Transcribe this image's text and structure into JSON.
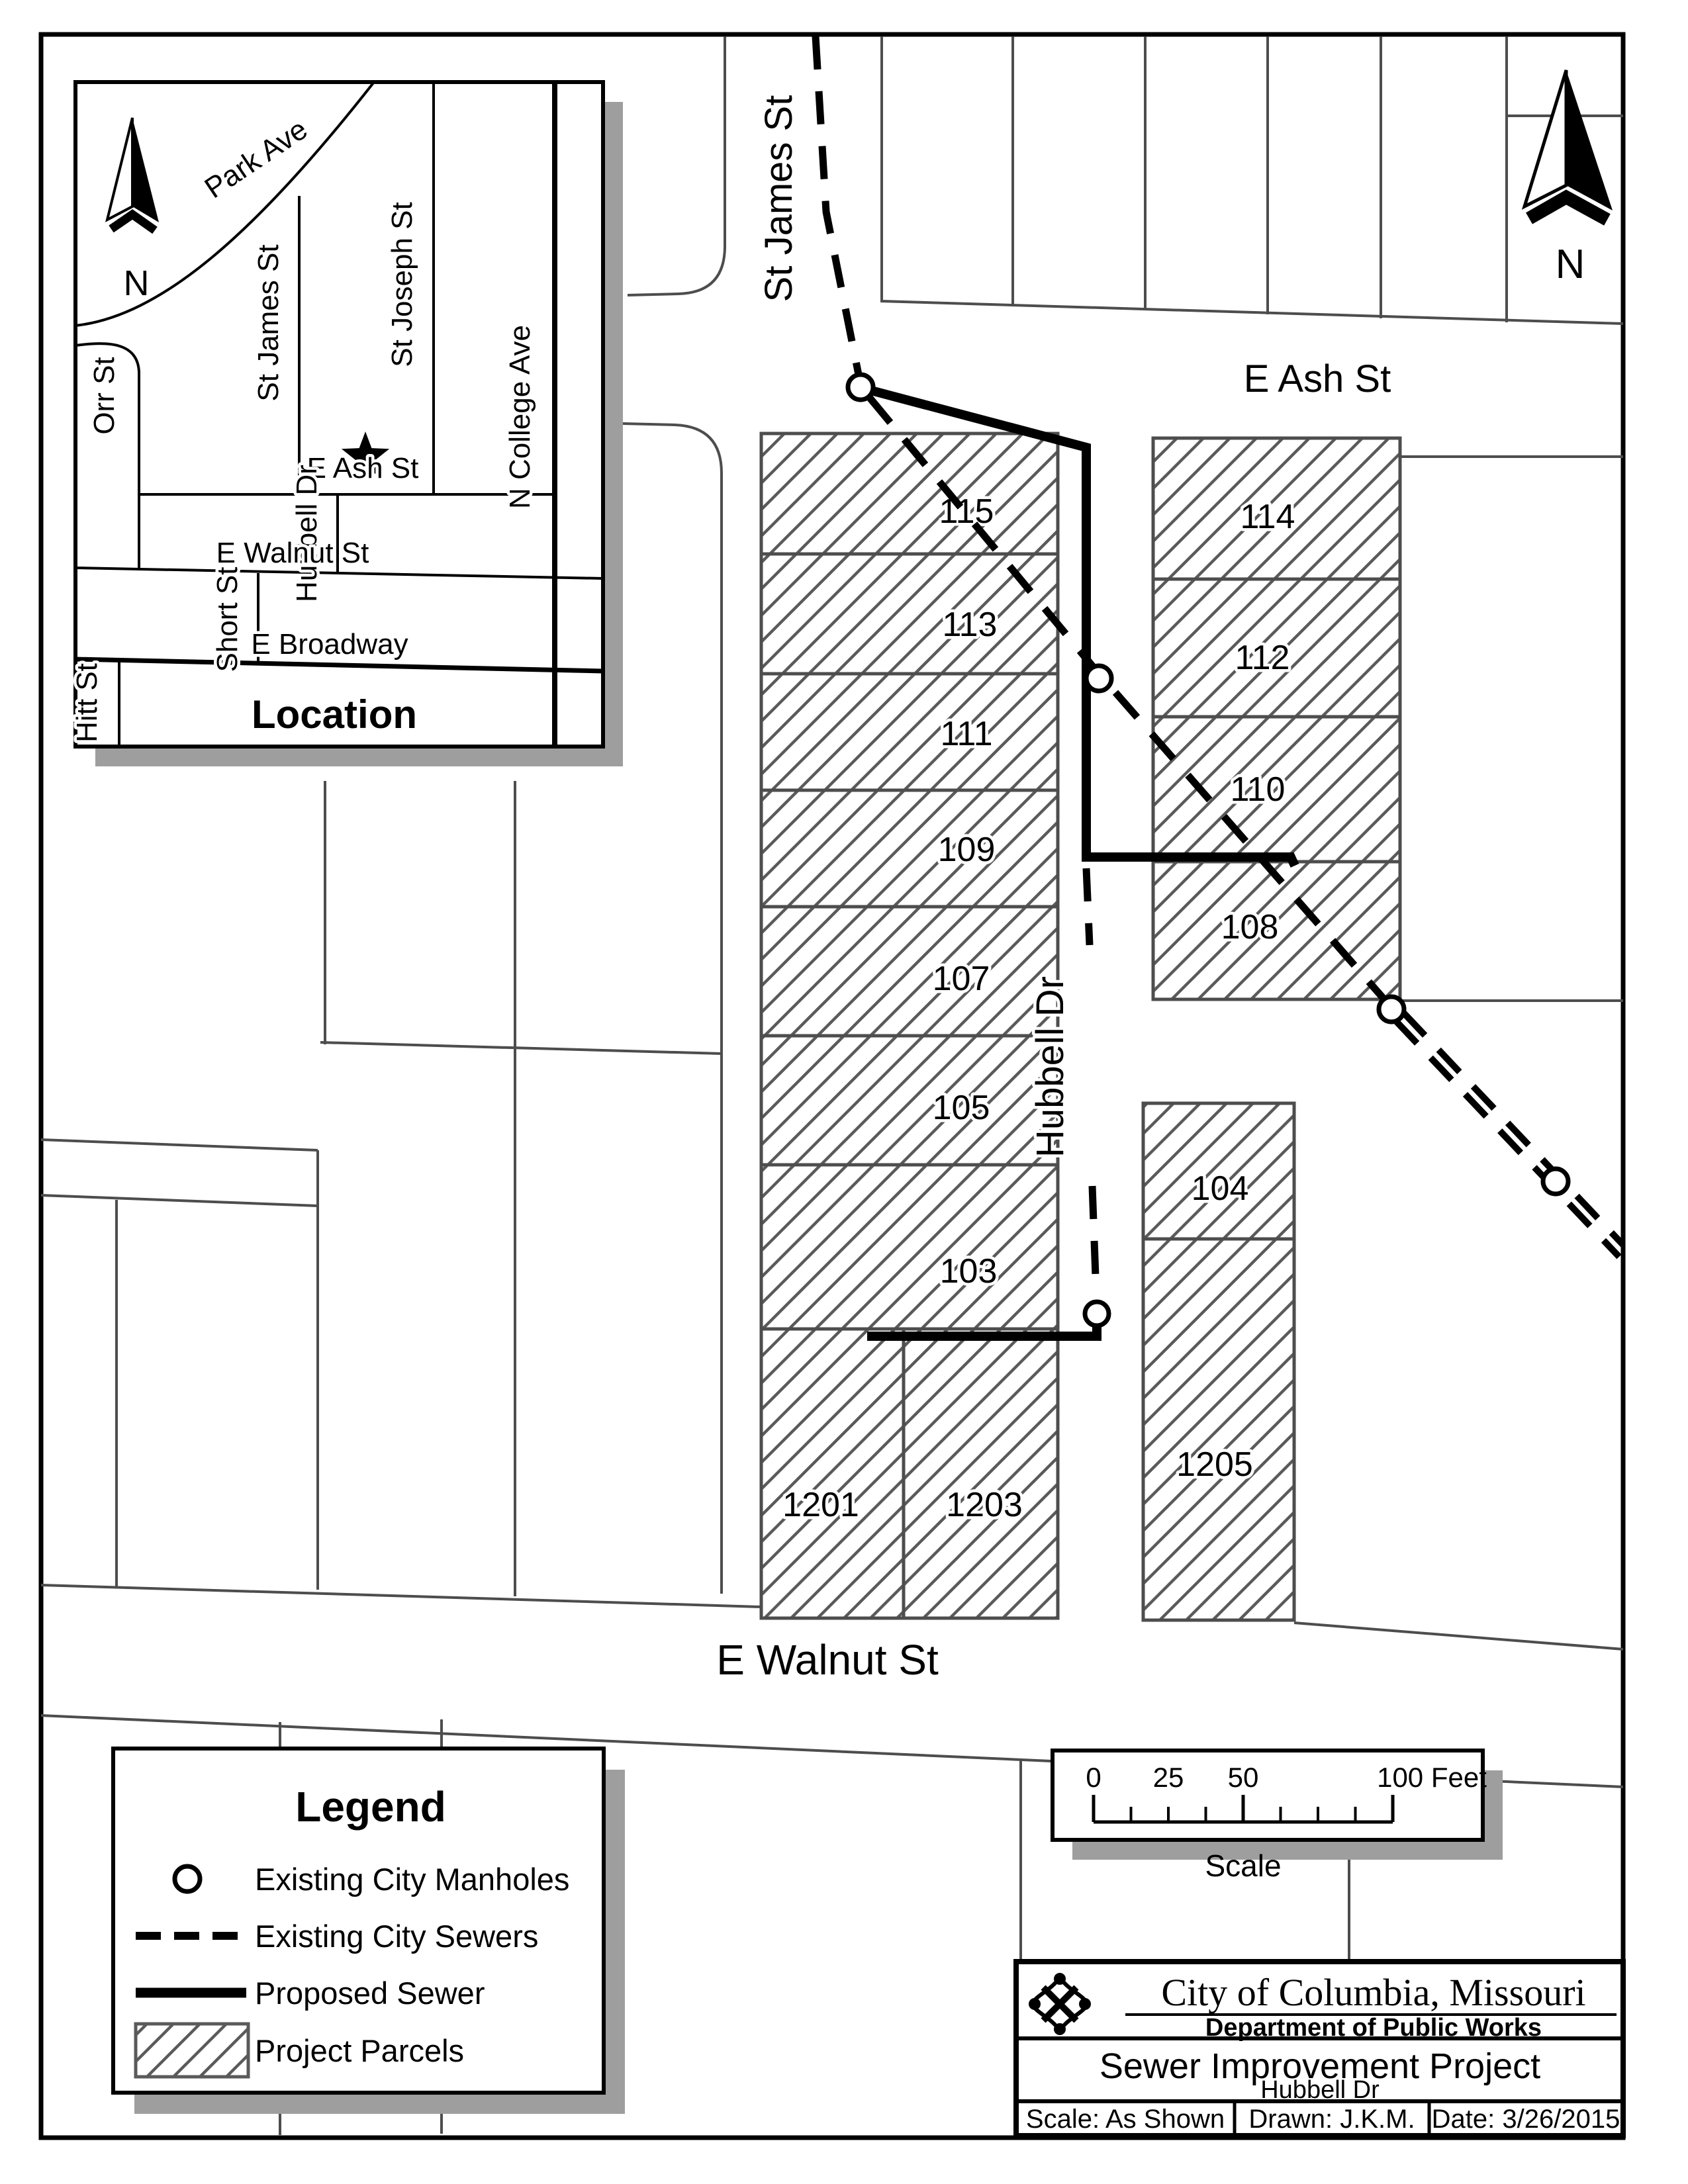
{
  "inset": {
    "title": "Location",
    "north": "N",
    "streets": {
      "park": "Park Ave",
      "st_james": "St James St",
      "st_joseph": "St Joseph St",
      "e_ash": "E Ash St",
      "orr": "Orr St",
      "hubbell": "Hubbell Dr",
      "n_college": "N College Ave",
      "e_walnut": "E Walnut St",
      "short": "Short St",
      "e_broadway": "E Broadway",
      "hitt": "Hitt St"
    }
  },
  "main": {
    "north": "N",
    "streets": {
      "st_james": "St James St",
      "e_ash": "E Ash St",
      "hubbell": "Hubbell Dr",
      "e_walnut": "E Walnut St"
    },
    "parcels_left": [
      "115",
      "113",
      "111",
      "109",
      "107",
      "105",
      "103",
      "1201",
      "1203"
    ],
    "parcels_right": [
      "114",
      "112",
      "110",
      "108",
      "104",
      "1205"
    ]
  },
  "legend": {
    "title": "Legend",
    "items": [
      {
        "symbol": "manhole-circle",
        "label": "Existing City Manholes"
      },
      {
        "symbol": "dashed-line",
        "label": "Existing City Sewers"
      },
      {
        "symbol": "solid-line",
        "label": "Proposed Sewer"
      },
      {
        "symbol": "hatch-swatch",
        "label": "Project Parcels"
      }
    ]
  },
  "scale_bar": {
    "labels": [
      "0",
      "25",
      "50",
      "100 Feet"
    ],
    "caption": "Scale"
  },
  "title_block": {
    "agency": "City of Columbia, Missouri",
    "department": "Department of Public Works",
    "project": "Sewer Improvement Project",
    "location": "Hubbell Dr",
    "scale": "Scale: As Shown",
    "drawn": "Drawn: J.K.M.",
    "date": "Date: 3/26/2015"
  },
  "colors": {
    "parcel_line_gray": "#4d4d4d",
    "hatch_gray": "#5a5a5a",
    "shadow_gray": "#9e9e9e",
    "sewer_black": "#000000"
  }
}
